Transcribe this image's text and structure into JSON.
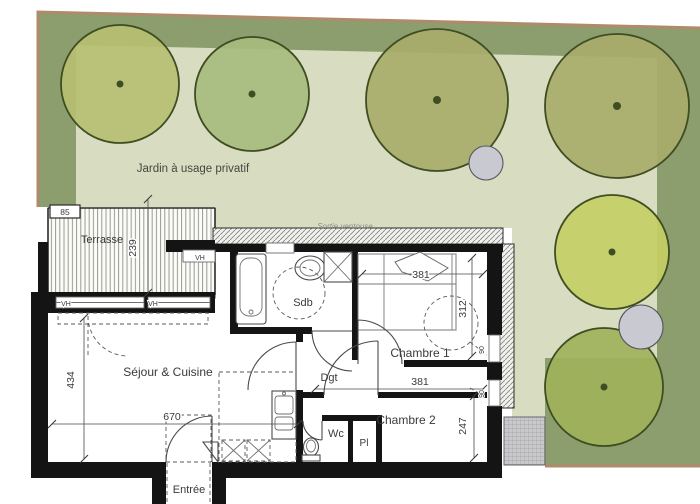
{
  "plan": {
    "labels": {
      "jardin": "Jardin à usage privatif",
      "terrasse": "Terrasse",
      "sejour": "Séjour & Cuisine",
      "sdb": "Sdb",
      "chambre1": "Chambre 1",
      "chambre2": "Chambre 2",
      "dgt": "Dgt",
      "wc": "Wc",
      "pl": "Pl",
      "entree": "Entrée",
      "sortie_ventouse": "Sortie ventouse"
    },
    "dimensions": {
      "terrasse_depth": "239",
      "terrasse_box": "85",
      "sejour_height": "434",
      "sejour_width": "670",
      "chambre1_width": "381",
      "chambre1_depth": "312",
      "chambre2_width": "381",
      "chambre2_depth": "247",
      "window_ch1": "90",
      "window_ch2": "90",
      "window_tag": "VH"
    },
    "colors": {
      "garden_dark": "#8c9e6d",
      "garden_light": "#d8dcc0",
      "tree_olive": "#a8ad6b",
      "tree_yellow": "#b6bf72",
      "tree_green": "#a7bc7f",
      "tree_green2": "#9fb25b",
      "tree_bright": "#c4cf66",
      "tree_outline": "#3f4d22",
      "gray_circle": "#c9c9d2",
      "edge_brown": "#b08a6a",
      "wall_black": "#141414",
      "paving_gray": "#c4c4c8"
    }
  }
}
